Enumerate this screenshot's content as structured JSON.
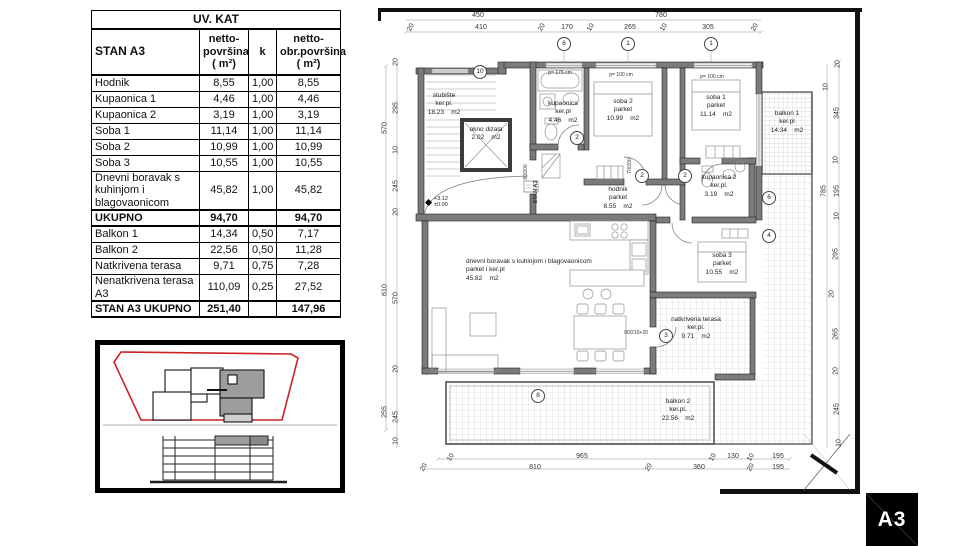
{
  "table": {
    "title": "UV. KAT",
    "header": {
      "col1": "STAN A3",
      "col2": "netto-\npovršina\n( m²)",
      "col3": "k",
      "col4": "netto-\nobr.površina\n( m²)"
    },
    "rows": [
      {
        "name": "Hodnik",
        "netto": "8,55",
        "k": "1,00",
        "obr": "8,55"
      },
      {
        "name": "Kupaonica 1",
        "netto": "4,46",
        "k": "1,00",
        "obr": "4,46"
      },
      {
        "name": "Kupaonica 2",
        "netto": "3,19",
        "k": "1,00",
        "obr": "3,19"
      },
      {
        "name": "Soba 1",
        "netto": "11,14",
        "k": "1,00",
        "obr": "11,14"
      },
      {
        "name": "Soba 2",
        "netto": "10,99",
        "k": "1,00",
        "obr": "10,99"
      },
      {
        "name": "Soba 3",
        "netto": "10,55",
        "k": "1,00",
        "obr": "10,55"
      },
      {
        "name": "Dnevni boravak s kuhinjom i blagovaonicom",
        "netto": "45,82",
        "k": "1,00",
        "obr": "45,82"
      },
      {
        "name": "UKUPNO",
        "netto": "94,70",
        "k": "",
        "obr": "94,70",
        "bold": true
      },
      {
        "name": "Balkon 1",
        "netto": "14,34",
        "k": "0,50",
        "obr": "7,17"
      },
      {
        "name": "Balkon 2",
        "netto": "22,56",
        "k": "0,50",
        "obr": "11,28"
      },
      {
        "name": "Natkrivena terasa",
        "netto": "9,71",
        "k": "0,75",
        "obr": "7,28"
      },
      {
        "name": "Nenatkrivena  terasa A3",
        "netto": "110,09",
        "k": "0,25",
        "obr": "27,52"
      },
      {
        "name": "STAN A3 UKUPNO",
        "netto": "251,40",
        "k": "",
        "obr": "147,96",
        "bold": true
      }
    ]
  },
  "plan": {
    "entry_label": "STAN A3",
    "level": {
      "top": "+3.12",
      "bottom": "±0.00"
    },
    "rooms": [
      {
        "x": 66,
        "y": 84,
        "lines": [
          "stubište",
          "ker.pl.",
          "18.23    m2"
        ]
      },
      {
        "x": 108,
        "y": 118,
        "lines": [
          "okno dizala",
          "2.02    m2"
        ]
      },
      {
        "x": 185,
        "y": 92,
        "lines": [
          "kupaonica",
          "ker.pl",
          "4.46    m2"
        ]
      },
      {
        "x": 245,
        "y": 90,
        "lines": [
          "soba 2",
          "parket",
          "10.99    m2"
        ]
      },
      {
        "x": 338,
        "y": 86,
        "lines": [
          "soba 1",
          "parket",
          "11.14    m2"
        ]
      },
      {
        "x": 409,
        "y": 102,
        "lines": [
          "balkon 1",
          "ker.pl",
          "14.34    m2"
        ]
      },
      {
        "x": 240,
        "y": 178,
        "lines": [
          "hodnik",
          "parket",
          "8.55    m2"
        ]
      },
      {
        "x": 341,
        "y": 166,
        "lines": [
          "kupaonica 2",
          "ker.pl.",
          "3.19    m2"
        ]
      },
      {
        "x": 344,
        "y": 244,
        "lines": [
          "soba 3",
          "parket",
          "10.55    m2"
        ]
      },
      {
        "x": 88,
        "y": 250,
        "a": "l",
        "lines": [
          "dnevni boravak s kuhinjom i blagovaonicom",
          "parket i ker.pl",
          "45.82    m2"
        ]
      },
      {
        "x": 318,
        "y": 308,
        "lines": [
          "natkrivena terasa",
          "ker.pl.",
          "9.71    m2"
        ]
      },
      {
        "x": 300,
        "y": 390,
        "lines": [
          "balkon 2",
          "ker.pl.",
          "22.56    m2"
        ]
      }
    ],
    "dims": [
      {
        "t": "450",
        "x": 100,
        "y": 4
      },
      {
        "t": "780",
        "x": 283,
        "y": 4
      },
      {
        "t": "20",
        "x": 33,
        "y": 16,
        "r": 2
      },
      {
        "t": "410",
        "x": 103,
        "y": 16
      },
      {
        "t": "20",
        "x": 164,
        "y": 16,
        "r": 2
      },
      {
        "t": "170",
        "x": 189,
        "y": 16
      },
      {
        "t": "10",
        "x": 213,
        "y": 16,
        "r": 2
      },
      {
        "t": "265",
        "x": 252,
        "y": 16
      },
      {
        "t": "10",
        "x": 286,
        "y": 16,
        "r": 2
      },
      {
        "t": "305",
        "x": 330,
        "y": 16
      },
      {
        "t": "20",
        "x": 377,
        "y": 16,
        "r": 2
      },
      {
        "t": "570",
        "x": 7,
        "y": 120,
        "r": 1
      },
      {
        "t": "610",
        "x": 7,
        "y": 282,
        "r": 1
      },
      {
        "t": "255",
        "x": 7,
        "y": 404,
        "r": 1
      },
      {
        "t": "20",
        "x": 18,
        "y": 54,
        "r": 1
      },
      {
        "t": "295",
        "x": 18,
        "y": 100,
        "r": 1
      },
      {
        "t": "10",
        "x": 18,
        "y": 142,
        "r": 1
      },
      {
        "t": "245",
        "x": 18,
        "y": 178,
        "r": 1
      },
      {
        "t": "20",
        "x": 18,
        "y": 204,
        "r": 1
      },
      {
        "t": "570",
        "x": 18,
        "y": 290,
        "r": 1
      },
      {
        "t": "20",
        "x": 18,
        "y": 361,
        "r": 1
      },
      {
        "t": "245",
        "x": 18,
        "y": 409,
        "r": 1
      },
      {
        "t": "10",
        "x": 18,
        "y": 433,
        "r": 1
      },
      {
        "t": "20",
        "x": 460,
        "y": 56,
        "r": 1
      },
      {
        "t": "10",
        "x": 448,
        "y": 79,
        "r": 1
      },
      {
        "t": "345",
        "x": 459,
        "y": 105,
        "r": 1
      },
      {
        "t": "10",
        "x": 458,
        "y": 152,
        "r": 1
      },
      {
        "t": "785",
        "x": 446,
        "y": 183,
        "r": 1
      },
      {
        "t": "195",
        "x": 459,
        "y": 183,
        "r": 1
      },
      {
        "t": "10",
        "x": 459,
        "y": 208,
        "r": 1
      },
      {
        "t": "295",
        "x": 458,
        "y": 246,
        "r": 1
      },
      {
        "t": "20",
        "x": 454,
        "y": 286,
        "r": 1
      },
      {
        "t": "265",
        "x": 458,
        "y": 326,
        "r": 1
      },
      {
        "t": "20",
        "x": 458,
        "y": 363,
        "r": 1
      },
      {
        "t": "245",
        "x": 459,
        "y": 401,
        "r": 1
      },
      {
        "t": "10",
        "x": 461,
        "y": 435,
        "r": 1
      },
      {
        "t": "10",
        "x": 73,
        "y": 446,
        "r": 2
      },
      {
        "t": "965",
        "x": 204,
        "y": 445
      },
      {
        "t": "10",
        "x": 335,
        "y": 446,
        "r": 2
      },
      {
        "t": "130",
        "x": 355,
        "y": 445
      },
      {
        "t": "10",
        "x": 373,
        "y": 446,
        "r": 2
      },
      {
        "t": "195",
        "x": 400,
        "y": 445
      },
      {
        "t": "20",
        "x": 46,
        "y": 456,
        "r": 2
      },
      {
        "t": "810",
        "x": 157,
        "y": 456
      },
      {
        "t": "20",
        "x": 271,
        "y": 456,
        "r": 2
      },
      {
        "t": "360",
        "x": 321,
        "y": 456
      },
      {
        "t": "20",
        "x": 373,
        "y": 456,
        "r": 2
      },
      {
        "t": "195",
        "x": 400,
        "y": 456
      },
      {
        "t": "p= 175 cm",
        "x": 182,
        "y": 62,
        "s": 5
      },
      {
        "t": "p= 100 cm",
        "x": 243,
        "y": 64,
        "s": 5
      },
      {
        "t": "p= 100 cm",
        "x": 334,
        "y": 66,
        "s": 5
      },
      {
        "t": "90/210+20",
        "x": 258,
        "y": 322,
        "s": 5
      },
      {
        "t": "70/200",
        "x": 252,
        "y": 158,
        "r": 1,
        "s": 5
      },
      {
        "t": "80/200",
        "x": 148,
        "y": 164,
        "r": 1,
        "s": 5
      }
    ],
    "markers": [
      {
        "t": "6",
        "x": 186,
        "y": 36
      },
      {
        "t": "1",
        "x": 250,
        "y": 36
      },
      {
        "t": "1",
        "x": 333,
        "y": 36
      },
      {
        "t": "10",
        "x": 102,
        "y": 64
      },
      {
        "t": "2",
        "x": 199,
        "y": 130
      },
      {
        "t": "2",
        "x": 264,
        "y": 168
      },
      {
        "t": "2",
        "x": 307,
        "y": 168
      },
      {
        "t": "3",
        "x": 288,
        "y": 328
      },
      {
        "t": "8",
        "x": 160,
        "y": 388
      },
      {
        "t": "6",
        "x": 391,
        "y": 190
      },
      {
        "t": "4",
        "x": 391,
        "y": 228
      }
    ]
  },
  "sheet": {
    "code": "A3"
  }
}
